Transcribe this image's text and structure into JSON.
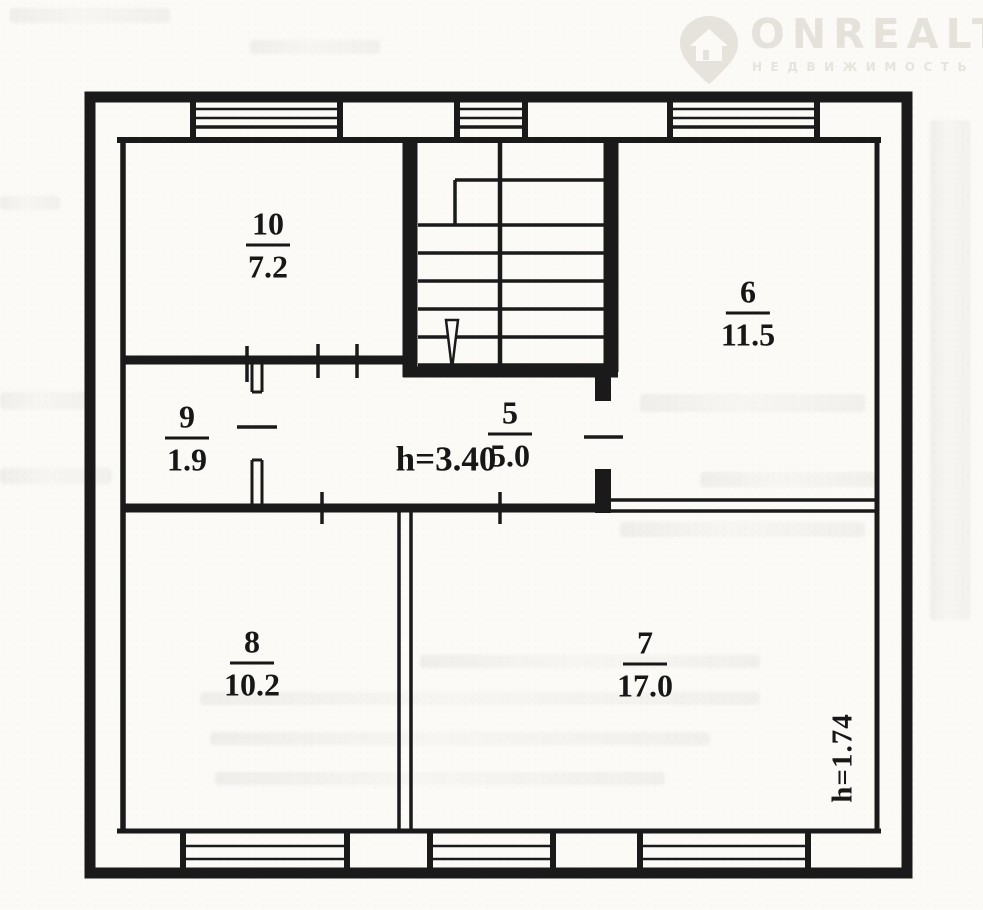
{
  "watermark": {
    "brand": "ONREALT",
    "tagline": "НЕДВИЖИМОСТЬ",
    "icon": "house-pin-icon",
    "color_hex": "#e5e2db"
  },
  "labels": {
    "corridor_height": "h=3.40",
    "side_height": "h=1.74"
  },
  "rooms": [
    {
      "number": "10",
      "area": "7.2"
    },
    {
      "number": "6",
      "area": "11.5"
    },
    {
      "number": "9",
      "area": "1.9"
    },
    {
      "number": "5",
      "area": "5.0"
    },
    {
      "number": "8",
      "area": "10.2"
    },
    {
      "number": "7",
      "area": "17.0"
    }
  ]
}
